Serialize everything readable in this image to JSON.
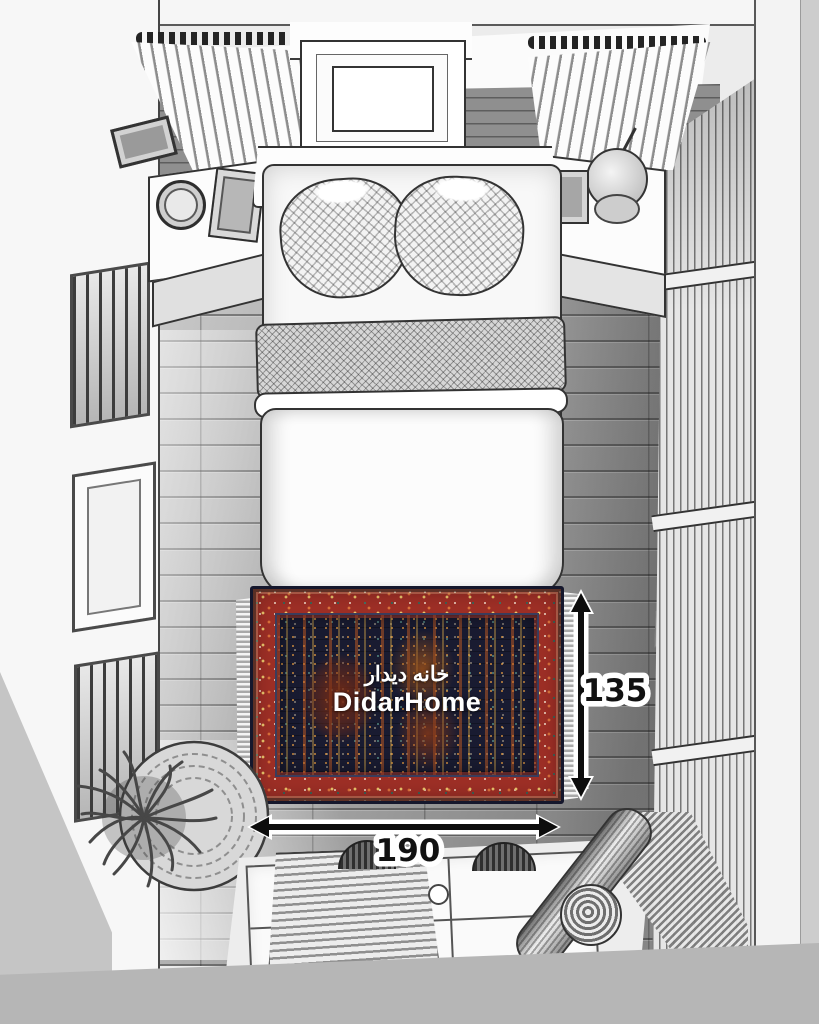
{
  "scene_title": "Top-down bedroom sketch with rug size diagram",
  "watermark": {
    "brand_fa": "خانه دیدار",
    "brand_en": "DidarHome"
  },
  "dimensions": {
    "rug_width": "190",
    "rug_height": "135"
  },
  "icons": {
    "width_arrow": "double-headed-horizontal-arrow",
    "height_arrow": "double-headed-vertical-arrow"
  },
  "colors": {
    "rug_border_red": "#9e2f26",
    "rug_field_navy": "#191b31",
    "rug_accent_gold": "#d9a84e",
    "rug_accent_teal": "#3f7a72",
    "dimension_text": "#111111",
    "dimension_outline": "#ffffff",
    "sketch_gray": "#a2a2a2"
  }
}
